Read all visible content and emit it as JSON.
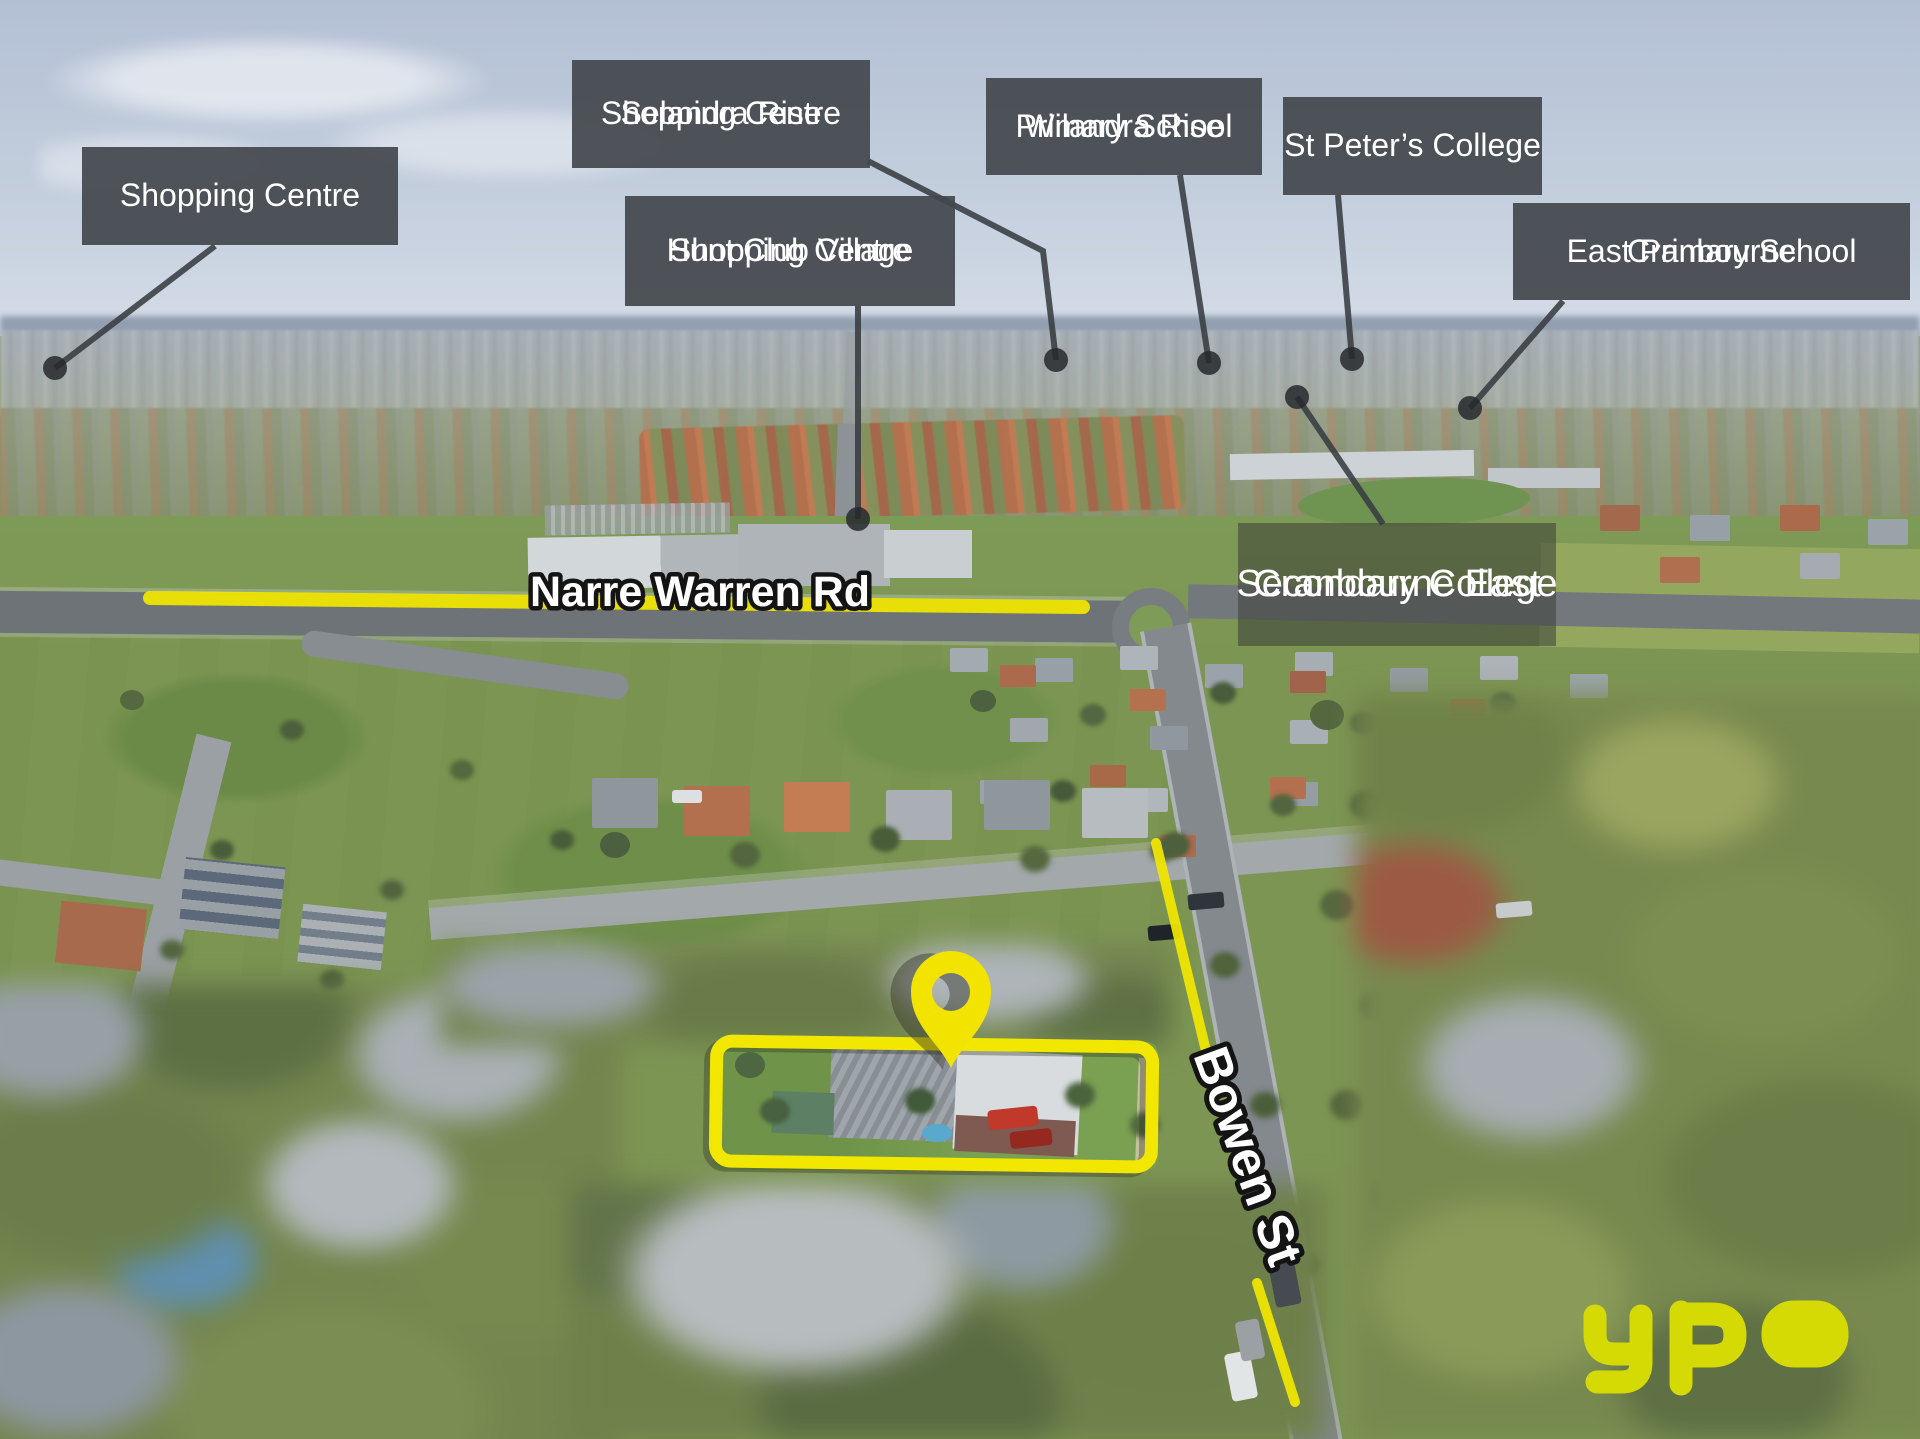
{
  "labels": {
    "shopping_centre": {
      "text": "Shopping Centre"
    },
    "selandra_rise": {
      "line1": "Selandra Rise",
      "line2": "Shopping Centre"
    },
    "hunt_club": {
      "line1": "Hunt Club Village",
      "line2": "Shopping Centre"
    },
    "wilandra_rise": {
      "line1": "Wilandra Rise",
      "line2": "Primary School"
    },
    "st_peters": {
      "text": "St Peter’s College"
    },
    "cranbourne_east_primary": {
      "line1": "Cranbourne",
      "line2": "East Primary School"
    },
    "cranbourne_east_secondary": {
      "line1": "Cranbourne East",
      "line2": "Secondary College"
    }
  },
  "roads": {
    "narre_warren": "Narre Warren Rd",
    "bowen": "Bowen St"
  },
  "branding": {
    "agency_logo": "ypa"
  },
  "colors": {
    "highlight_yellow": "#f2e700",
    "label_background": "#44484d",
    "leader_line": "#383c41",
    "logo_yellow": "#d6da04"
  }
}
